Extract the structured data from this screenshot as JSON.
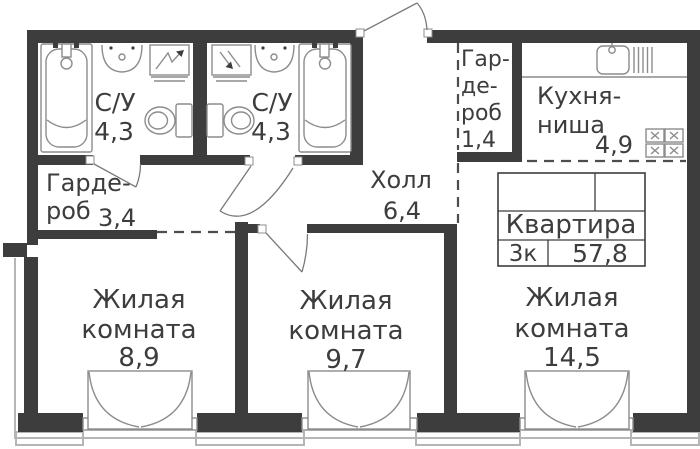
{
  "rooms": {
    "bathroom1": {
      "label": "С/У",
      "area": "4,3"
    },
    "bathroom2": {
      "label": "С/У",
      "area": "4,3"
    },
    "wardrobe_small": {
      "line1": "Гар-",
      "line2": "де-",
      "line3": "роб",
      "area": "1,4"
    },
    "kitchen": {
      "line1": "Кухня-",
      "line2": "ниша",
      "area": "4,9"
    },
    "wardrobe": {
      "line1": "Гарде-",
      "line2": "роб",
      "area": "3,4"
    },
    "hall": {
      "label": "Холл",
      "area": "6,4"
    },
    "living1": {
      "line1": "Жилая",
      "line2": "комната",
      "area": "8,9"
    },
    "living2": {
      "line1": "Жилая",
      "line2": "комната",
      "area": "9,7"
    },
    "living3": {
      "line1": "Жилая",
      "line2": "комната",
      "area": "14,5"
    }
  },
  "info_table": {
    "title": "Квартира",
    "rooms_count": "3к",
    "total_area": "57,8"
  },
  "colors": {
    "wall": "#3d3d3d",
    "fixture_line": "#8c8c8c",
    "dashed_line": "#4d4d4d",
    "balcony_line": "#b5b5b5",
    "text": "#3d3d3d",
    "background": "#ffffff"
  }
}
